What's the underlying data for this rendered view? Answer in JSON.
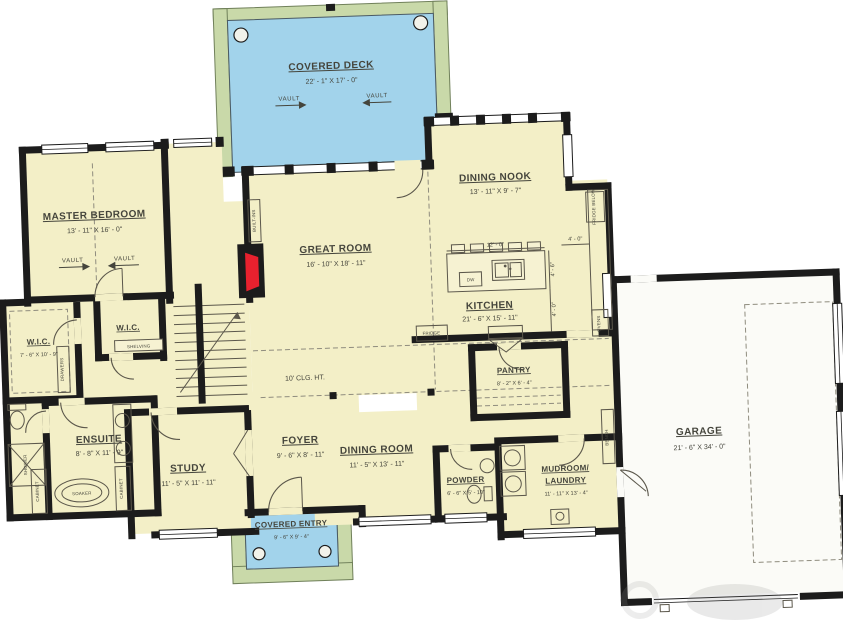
{
  "colors": {
    "room_fill": "#f3efc7",
    "deck_fill": "#a2d3eb",
    "porch_frame": "#c9d9a9",
    "wall": "#1c1c1c",
    "fireplace_red": "#e8212e",
    "garage_fill": "#fbfbf7",
    "label_text": "#45453c"
  },
  "rooms": {
    "covered_deck": {
      "name": "COVERED DECK",
      "dims": "22' - 1\" X 17' - 0\""
    },
    "master_bedroom": {
      "name": "MASTER BEDROOM",
      "dims": "13' - 11\" X 16' - 0\""
    },
    "great_room": {
      "name": "GREAT ROOM",
      "dims": "16' - 10\" X 18' - 11\""
    },
    "dining_nook": {
      "name": "DINING NOOK",
      "dims": "13' - 11\" X 9' - 7\""
    },
    "kitchen": {
      "name": "KITCHEN",
      "dims": "21' - 6\" X 15' - 11\""
    },
    "wic_primary": {
      "name": "W.I.C.",
      "dims": "7' - 6\" X 10' - 9\""
    },
    "wic_secondary": {
      "name": "W.I.C."
    },
    "ensuite": {
      "name": "ENSUITE",
      "dims": "8' - 8\" X 11' - 9\""
    },
    "study": {
      "name": "STUDY",
      "dims": "11' - 5\" X 11' - 11\""
    },
    "foyer": {
      "name": "FOYER",
      "dims": "9' - 6\" X 8' - 11\""
    },
    "dining_room": {
      "name": "DINING ROOM",
      "dims": "11' - 5\" X 13' - 11\""
    },
    "powder": {
      "name": "POWDER",
      "dims": "6' - 6\" X 5' - 10\""
    },
    "pantry": {
      "name": "PANTRY",
      "dims": "8' - 2\" X 6' - 4\""
    },
    "mudroom_laundry": {
      "line1": "MUDROOM/",
      "line2": "LAUNDRY",
      "dims": "11' - 11\" X 13' - 4\""
    },
    "garage": {
      "name": "GARAGE",
      "dims": "21' - 6\" X 34' - 0\""
    },
    "covered_entry": {
      "name": "COVERED ENTRY",
      "dims": "9' - 6\" X 9' - 4\""
    }
  },
  "annotations": {
    "ceiling_height": "10' CLG. HT.",
    "vault": "VAULT",
    "built_ins": "BUILT-INS",
    "shelving": "SHELVING",
    "drawers": "DRAWERS",
    "cabinet": "CABINET",
    "soaker": "SOAKER",
    "shower": "SHOWER",
    "fridge": "FRIDGE",
    "fridge_below": "FRIDGE BELOW",
    "ovens": "OVENS",
    "dw": "DW",
    "bench": "BENCH",
    "island_length": "12' - 0\"",
    "island_width": "4' - 6\"",
    "island_clearance": "4' - 0\""
  }
}
